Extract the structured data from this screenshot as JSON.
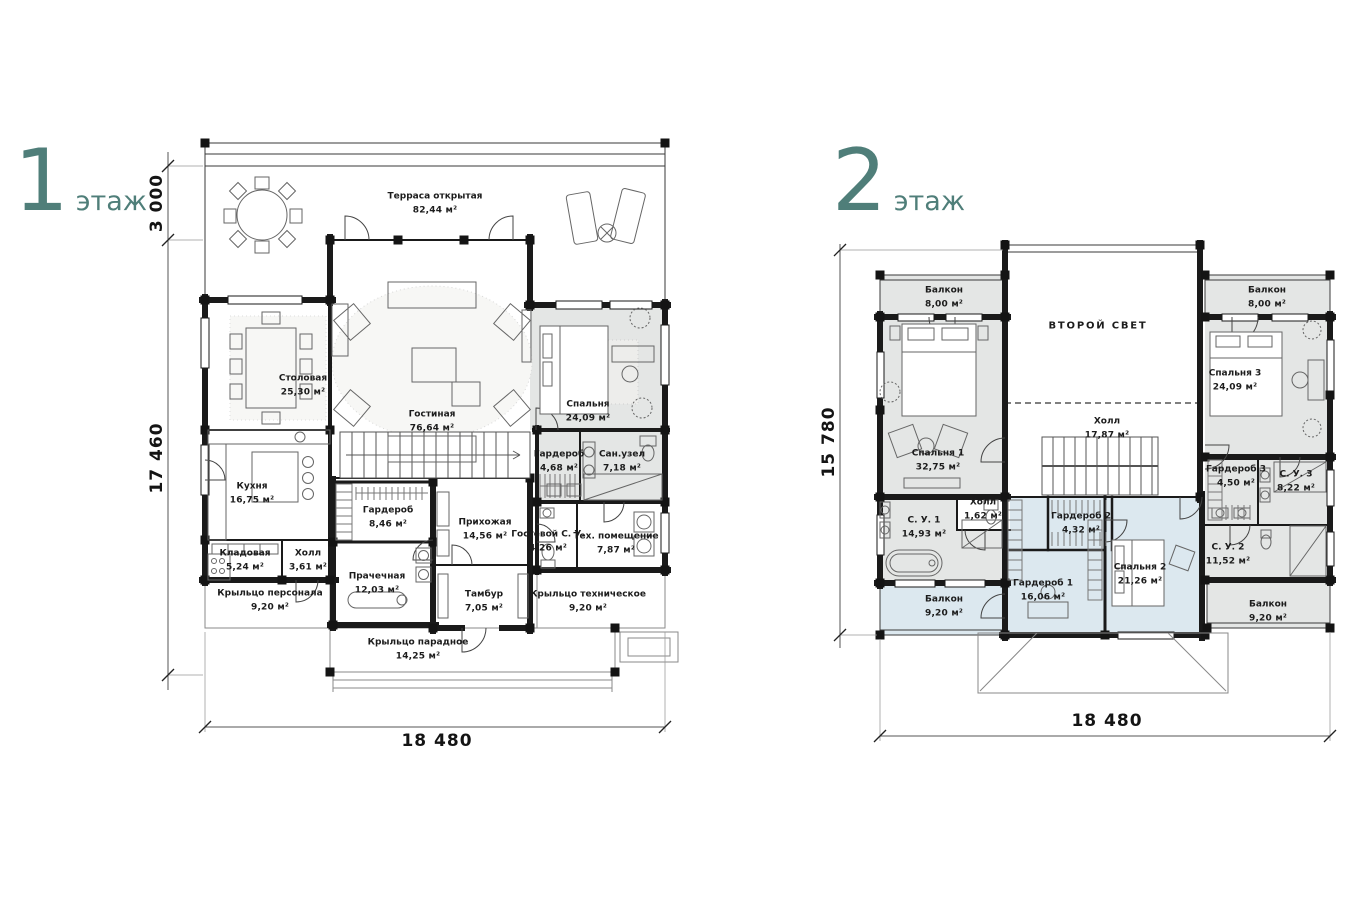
{
  "page": {
    "background": "#ffffff"
  },
  "colors": {
    "accent_teal": "#4f7e79",
    "room_gray_fill": "#e4e6e5",
    "room_blue_fill": "#dce8ef",
    "wall_black": "#1a1a1a"
  },
  "floor1": {
    "title_number": "1",
    "title_suffix": "этаж",
    "dims": {
      "terrace_depth": "3 000",
      "height": "17 460",
      "width": "18 480"
    },
    "rooms": [
      {
        "name": "Терраса открытая",
        "area": "82,44 м²"
      },
      {
        "name": "Столовая",
        "area": "25,30 м²"
      },
      {
        "name": "Гостиная",
        "area": "76,64 м²"
      },
      {
        "name": "Спальня",
        "area": "24,09 м²"
      },
      {
        "name": "Кухня",
        "area": "16,75 м²"
      },
      {
        "name": "Гардероб",
        "area": "8,46 м²"
      },
      {
        "name": "Гардероб",
        "area": "4,68 м²"
      },
      {
        "name": "Сан.узел",
        "area": "7,18 м²"
      },
      {
        "name": "Кладовая",
        "area": "5,24 м²"
      },
      {
        "name": "Холл",
        "area": "3,61 м²"
      },
      {
        "name": "Прихожая",
        "area": "14,56 м²"
      },
      {
        "name": "Гостевой С. У.",
        "area": "4,26 м²"
      },
      {
        "name": "Тех. помещение",
        "area": "7,87 м²"
      },
      {
        "name": "Крыльцо персонала",
        "area": "9,20 м²"
      },
      {
        "name": "Прачечная",
        "area": "12,03 м²"
      },
      {
        "name": "Тамбур",
        "area": "7,05 м²"
      },
      {
        "name": "Крыльцо техническое",
        "area": "9,20 м²"
      },
      {
        "name": "Крыльцо парадное",
        "area": "14,25 м²"
      }
    ]
  },
  "floor2": {
    "title_number": "2",
    "title_suffix": "этаж",
    "dims": {
      "height": "15 780",
      "width": "18 480"
    },
    "rooms": [
      {
        "name": "Балкон",
        "area": "8,00 м²"
      },
      {
        "name": "ВТОРОЙ СВЕТ",
        "area": ""
      },
      {
        "name": "Балкон",
        "area": "8,00 м²"
      },
      {
        "name": "Спальня 1",
        "area": "32,75 м²"
      },
      {
        "name": "Холл",
        "area": "17,87 м²"
      },
      {
        "name": "Спальня 3",
        "area": "24,09 м²"
      },
      {
        "name": "Холл",
        "area": "1,62 м²"
      },
      {
        "name": "С. У. 1",
        "area": "14,93 м²"
      },
      {
        "name": "Гардероб 2",
        "area": "4,32 м²"
      },
      {
        "name": "Гардероб 3",
        "area": "4,50 м²"
      },
      {
        "name": "С. У. 3",
        "area": "8,22 м²"
      },
      {
        "name": "Гардероб 1",
        "area": "16,06 м²"
      },
      {
        "name": "Спальня 2",
        "area": "21,26 м²"
      },
      {
        "name": "С. У. 2",
        "area": "11,52 м²"
      },
      {
        "name": "Балкон",
        "area": "9,20 м²"
      },
      {
        "name": "Балкон",
        "area": "9,20 м²"
      }
    ]
  }
}
